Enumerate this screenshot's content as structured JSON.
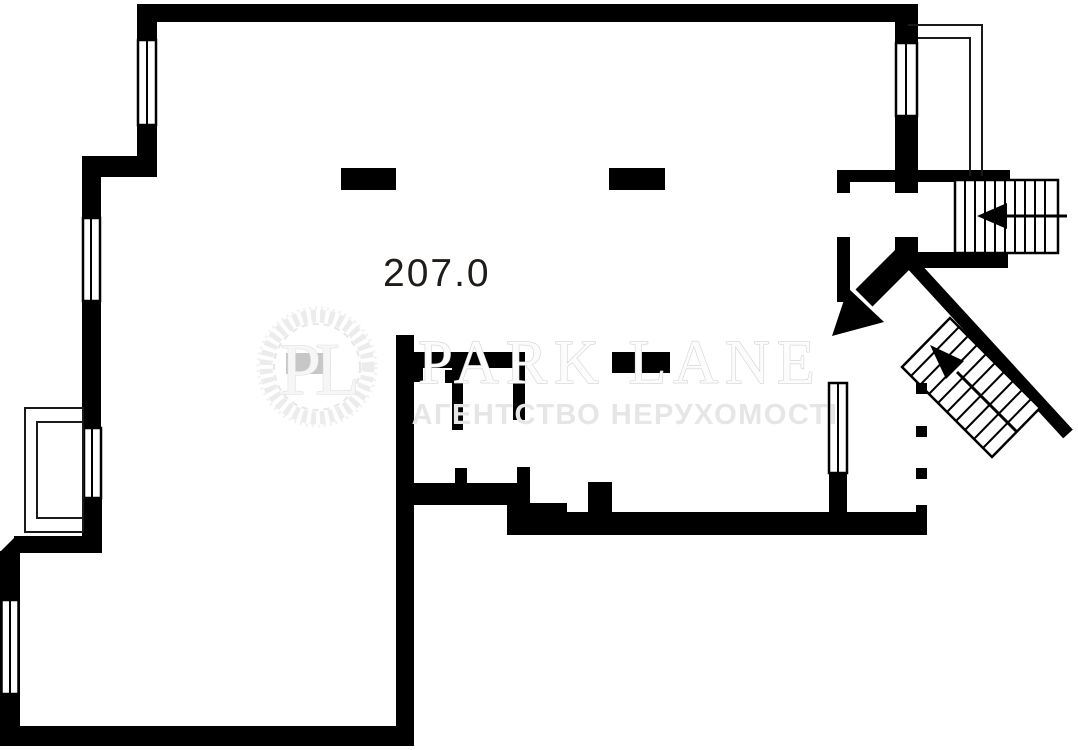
{
  "plan": {
    "area_label": "207.0",
    "type_note": "apartment floor plan"
  },
  "watermark": {
    "monogram": "PL",
    "title": "PARK LANE",
    "subtitle": "АГЕНТСТВО НЕРУХОМОСТІ"
  },
  "colors": {
    "walls": "#000000",
    "background": "#ffffff",
    "area_text": "#1f1b18",
    "watermark_fill": "#fcfcfc",
    "watermark_outline": "#d2d2d2",
    "watermark_subtitle": "#e6e6e6"
  }
}
